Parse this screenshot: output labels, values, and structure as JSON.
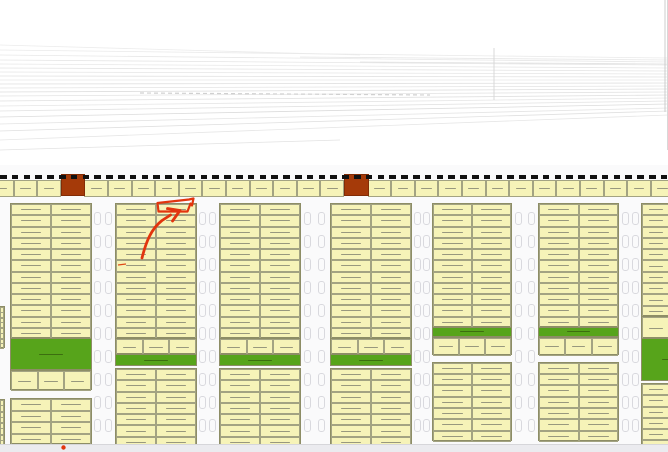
{
  "title": "residential subdivision plat plan with hand-drawn lot marker",
  "colors": {
    "plan_bg": "#fafafb",
    "lot_fill": "#f6f3b8",
    "lot_border": "#a3a382",
    "section_border": "#8d8d66",
    "squiggle": "#98987e",
    "green": "#57a41b",
    "green_label": "#3c6e10",
    "red_square": "#a53a09",
    "red_square_border": "#822c06",
    "boundary_dash": "#111111",
    "road_mark": "#d9d9de",
    "bottom_band": "#ebebef",
    "band_line": "#d6d6da",
    "faint_line": "#e4e4e4",
    "annotation": "#e2350e",
    "annotation_tick": "#e04a18"
  },
  "upper_drawing": {
    "lines": [
      [
        0,
        45,
        360,
        55,
        "#ececec"
      ],
      [
        0,
        50,
        668,
        58,
        "#eaeaea"
      ],
      [
        0,
        55,
        668,
        62,
        "#e8e8e8"
      ],
      [
        0,
        60,
        668,
        65,
        "#e6e6e6"
      ],
      [
        0,
        64,
        668,
        68,
        "#e8e8e8"
      ],
      [
        0,
        68,
        668,
        71,
        "#e4e4e4"
      ],
      [
        0,
        72,
        668,
        74,
        "#e6e6e6"
      ],
      [
        0,
        76,
        668,
        77,
        "#e2e2e2"
      ],
      [
        0,
        80,
        668,
        80,
        "#e6e6e6"
      ],
      [
        0,
        84,
        668,
        83,
        "#e0e0e0"
      ],
      [
        0,
        88,
        668,
        86,
        "#e4e4e4"
      ],
      [
        0,
        92,
        668,
        89,
        "#dedede"
      ],
      [
        0,
        96,
        668,
        92,
        "#e4e4e4"
      ],
      [
        0,
        101,
        668,
        95,
        "#e0e0e0"
      ],
      [
        0,
        106,
        668,
        98,
        "#e6e6e6"
      ],
      [
        0,
        111,
        668,
        101,
        "#e2e2e2"
      ],
      [
        0,
        117,
        668,
        104,
        "#dcdcdc"
      ],
      [
        0,
        124,
        668,
        108,
        "#e4e4e4"
      ],
      [
        0,
        131,
        668,
        111,
        "#e0e0e0"
      ],
      [
        0,
        140,
        668,
        115,
        "#e6e6e6"
      ],
      [
        0,
        150,
        340,
        140,
        "#e2e2e2"
      ],
      [
        300,
        57,
        668,
        60,
        "#e6e6e6"
      ],
      [
        360,
        62,
        668,
        64,
        "#e2e2e2"
      ]
    ],
    "vlines": [
      [
        494,
        48,
        494,
        100,
        "#d8d8d8"
      ],
      [
        665,
        0,
        665,
        112,
        "#cccccc"
      ],
      [
        667.5,
        0,
        667.5,
        150,
        "#d8d8d8"
      ]
    ],
    "dashed_line": [
      140,
      93,
      430,
      95,
      "#d0d0d0"
    ]
  },
  "boundary_strip": {
    "y": 180,
    "h": 17,
    "start_x": -10,
    "lot_w": 23.6,
    "count": 29,
    "red_lot_indices": [
      3,
      15
    ],
    "red_square": {
      "y": 174,
      "h": 22
    },
    "dashes": {
      "y": 174.5,
      "h": 4,
      "w": 6.5,
      "pitch": 11.8
    }
  },
  "blocks": [
    {
      "id": "block-1",
      "x": 10,
      "y": 203,
      "w": 82,
      "sections": [
        {
          "type": "rows",
          "rows": 12,
          "row_h": 11.25,
          "cols": 2
        },
        {
          "type": "green",
          "h": 32
        },
        {
          "type": "lots3",
          "h": 20
        }
      ]
    },
    {
      "id": "block-1-south",
      "x": 10,
      "y": 398,
      "w": 82,
      "sections": [
        {
          "type": "rows",
          "rows": 4,
          "row_h": 11.5,
          "cols": 2
        }
      ]
    },
    {
      "id": "block-2",
      "x": 115,
      "y": 203,
      "w": 82,
      "sections": [
        {
          "type": "rows",
          "rows": 12,
          "row_h": 11.25,
          "cols": 2
        },
        {
          "type": "lots3",
          "h": 16
        },
        {
          "type": "green",
          "h": 12
        },
        {
          "type": "gap",
          "h": 2
        },
        {
          "type": "rows",
          "rows": 7,
          "row_h": 11.3,
          "cols": 2
        }
      ]
    },
    {
      "id": "block-3",
      "x": 219,
      "y": 203,
      "w": 82,
      "sections": [
        {
          "type": "rows",
          "rows": 12,
          "row_h": 11.25,
          "cols": 2
        },
        {
          "type": "lots3",
          "h": 16
        },
        {
          "type": "green",
          "h": 12
        },
        {
          "type": "gap",
          "h": 2
        },
        {
          "type": "rows",
          "rows": 7,
          "row_h": 11.3,
          "cols": 2
        }
      ]
    },
    {
      "id": "block-4",
      "x": 330,
      "y": 203,
      "w": 82,
      "sections": [
        {
          "type": "rows",
          "rows": 12,
          "row_h": 11.25,
          "cols": 2
        },
        {
          "type": "lots3",
          "h": 16
        },
        {
          "type": "green",
          "h": 12
        },
        {
          "type": "gap",
          "h": 2
        },
        {
          "type": "rows",
          "rows": 7,
          "row_h": 11.3,
          "cols": 2
        }
      ]
    },
    {
      "id": "block-5",
      "x": 432,
      "y": 203,
      "w": 80,
      "sections": [
        {
          "type": "rows",
          "rows": 11,
          "row_h": 11.25,
          "cols": 2
        },
        {
          "type": "green",
          "h": 10
        },
        {
          "type": "lots3",
          "h": 18
        },
        {
          "type": "gap",
          "h": 7
        },
        {
          "type": "rows",
          "rows": 7,
          "row_h": 11.3,
          "cols": 2
        }
      ]
    },
    {
      "id": "block-6",
      "x": 538,
      "y": 203,
      "w": 81,
      "sections": [
        {
          "type": "rows",
          "rows": 11,
          "row_h": 11.25,
          "cols": 2
        },
        {
          "type": "green",
          "h": 10
        },
        {
          "type": "lots3",
          "h": 18
        },
        {
          "type": "gap",
          "h": 7
        },
        {
          "type": "rows",
          "rows": 7,
          "row_h": 11.3,
          "cols": 2
        }
      ]
    },
    {
      "id": "block-7",
      "x": 641,
      "y": 203,
      "w": 58,
      "sections": [
        {
          "type": "rows",
          "rows": 10,
          "row_h": 11.3,
          "cols": 2
        },
        {
          "type": "rows",
          "rows": 1,
          "row_h": 22,
          "cols": 2
        },
        {
          "type": "green",
          "h": 43
        },
        {
          "type": "gap",
          "h": 2
        },
        {
          "type": "rows",
          "rows": 6,
          "row_h": 11.3,
          "cols": 2
        }
      ]
    }
  ],
  "edge_slivers": [
    {
      "x": -1,
      "y": 306,
      "w": 6,
      "rows": 4,
      "row_h": 10.5
    },
    {
      "x": -1,
      "y": 399,
      "w": 6,
      "rows": 4,
      "row_h": 11.5
    }
  ],
  "parking_marks": {
    "w": 7,
    "h": 13,
    "pitch": 23,
    "y_start": 212,
    "y_end": 438,
    "columns": [
      [
        93.5,
        104.5
      ],
      [
        198.5,
        208.5
      ],
      [
        304,
        318
      ],
      [
        413.5,
        423
      ],
      [
        515,
        528
      ],
      [
        621.5,
        632
      ]
    ]
  },
  "bottom_road": {
    "y": 444,
    "h": 8
  },
  "annotation": {
    "arrow_icon": "hand-drawn-arrow",
    "highlight_outline_path": "M157.5,203 L189,199.5 L193.5,198.5 L192,205.5 L190.5,203.5 L187.5,211.5 L158.5,211.5 Z",
    "arrow_shaft_path": "M142,258 C146,242 151,229 162,220.5 L170.5,215",
    "arrow_head_path": "M167.5,208.5 L180,210.5 L172.5,221",
    "dot": {
      "cx": 63.5,
      "cy": 447.5,
      "r": 2.2
    },
    "red_tick": {
      "x1": 118,
      "y1": 265,
      "x2": 126,
      "y2": 264
    }
  }
}
